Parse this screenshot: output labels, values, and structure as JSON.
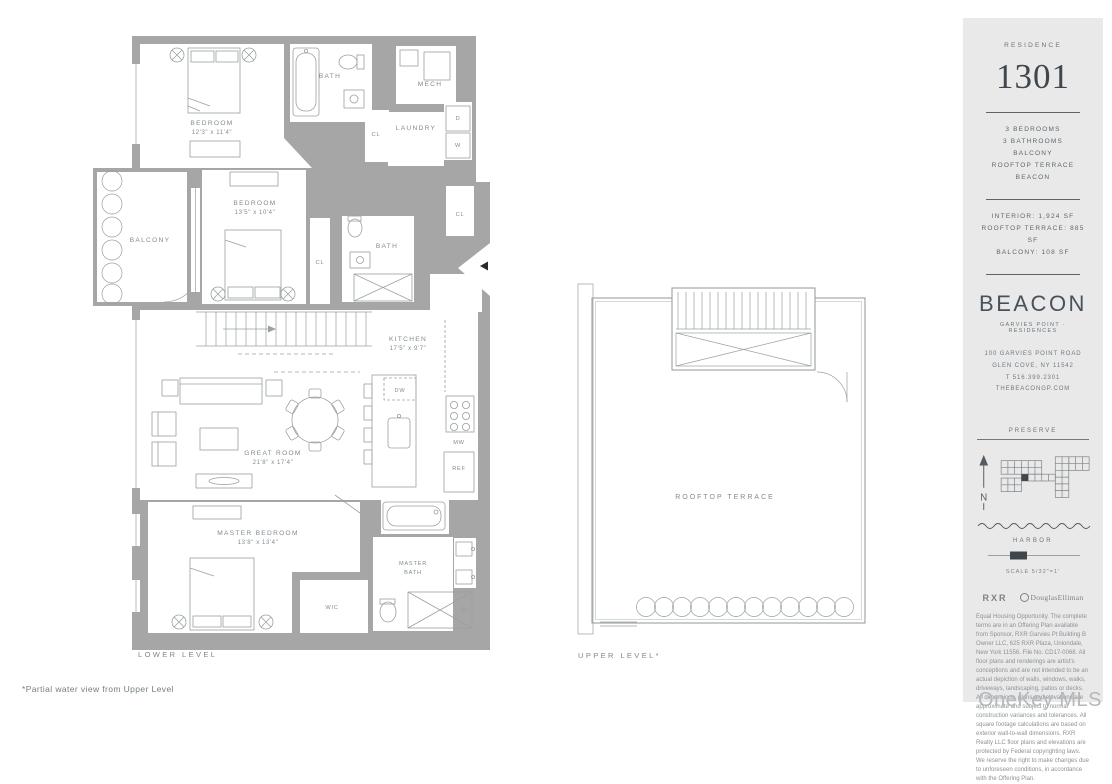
{
  "footnote": "*Partial water view from Upper Level",
  "watermark": "OneKey MLS",
  "colors": {
    "wall": "#a6a6a6",
    "plan_line": "#9aa0a3",
    "plan_label": "#828b90",
    "panel_bg": "#e9e9e9",
    "panel_text": "#5d666c",
    "accent_dark": "#3f474d",
    "watermark": "#b5b8ba"
  },
  "lower": {
    "caption": "LOWER LEVEL",
    "bedroom1_name": "BEDROOM",
    "bedroom1_dims": "12'3\" x 11'4\"",
    "bath1": "BATH",
    "mech": "MECH",
    "laundry": "LAUNDRY",
    "dryer": "D",
    "washer": "W",
    "cl": "CL",
    "balcony": "BALCONY",
    "bedroom2_name": "BEDROOM",
    "bedroom2_dims": "13'5\" x 10'4\"",
    "bath2": "BATH",
    "kitchen_name": "KITCHEN",
    "kitchen_dims": "17'5\" x 9'7\"",
    "dw": "DW",
    "mw": "MW",
    "ref": "REF",
    "great_name": "GREAT ROOM",
    "great_dims": "21'8\" x 17'4\"",
    "master_name": "MASTER BEDROOM",
    "master_dims": "13'8\" x 13'4\"",
    "wic": "WIC",
    "master_bath_line1": "MASTER",
    "master_bath_line2": "BATH"
  },
  "upper": {
    "caption": "UPPER LEVEL*",
    "terrace": "ROOFTOP TERRACE"
  },
  "panel": {
    "residence_label": "RESIDENCE",
    "unit_number": "1301",
    "features": [
      "3 BEDROOMS",
      "3 BATHROOMS",
      "BALCONY",
      "ROOFTOP TERRACE",
      "BEACON"
    ],
    "areas": [
      "INTERIOR: 1,924 SF",
      "ROOFTOP TERRACE: 885 SF",
      "BALCONY: 108 SF"
    ],
    "brand_name": "BEACON",
    "brand_tagline": "GARVIES POINT · RESIDENCES",
    "contact": [
      "100 GARVIES POINT ROAD",
      "GLEN COVE, NY 11542",
      "T 516.399.2301",
      "THEBEACONGP.COM"
    ],
    "map": {
      "preserve": "PRESERVE",
      "north": "N",
      "harbor": "HARBOR",
      "scale": "SCALE 5/32\"=1'"
    },
    "logos": {
      "rxr": "RXR",
      "elliman": "DouglasElliman"
    },
    "disclaimer": "Equal Housing Opportunity. The complete terms are in an Offering Plan available from Sponsor, RXR Garvies Pt Building B Owner LLC, 625 RXR Plaza, Uniondale, New York 11556. File No. CD17-0068. All floor plans and renderings are artist's conceptions and are not intended to be an actual depiction of walls, windows, walks, driveways, landscaping, patios or decks. All dimensions, plans and elevations are approximate and subject to normal construction variances and tolerances. All square footage calculations are based on exterior wall-to-wall dimensions. RXR Realty LLC floor plans and elevations are protected by Federal copyrighting laws. We reserve the right to make changes due to unforeseen conditions, in accordance with the Offering Plan."
  }
}
